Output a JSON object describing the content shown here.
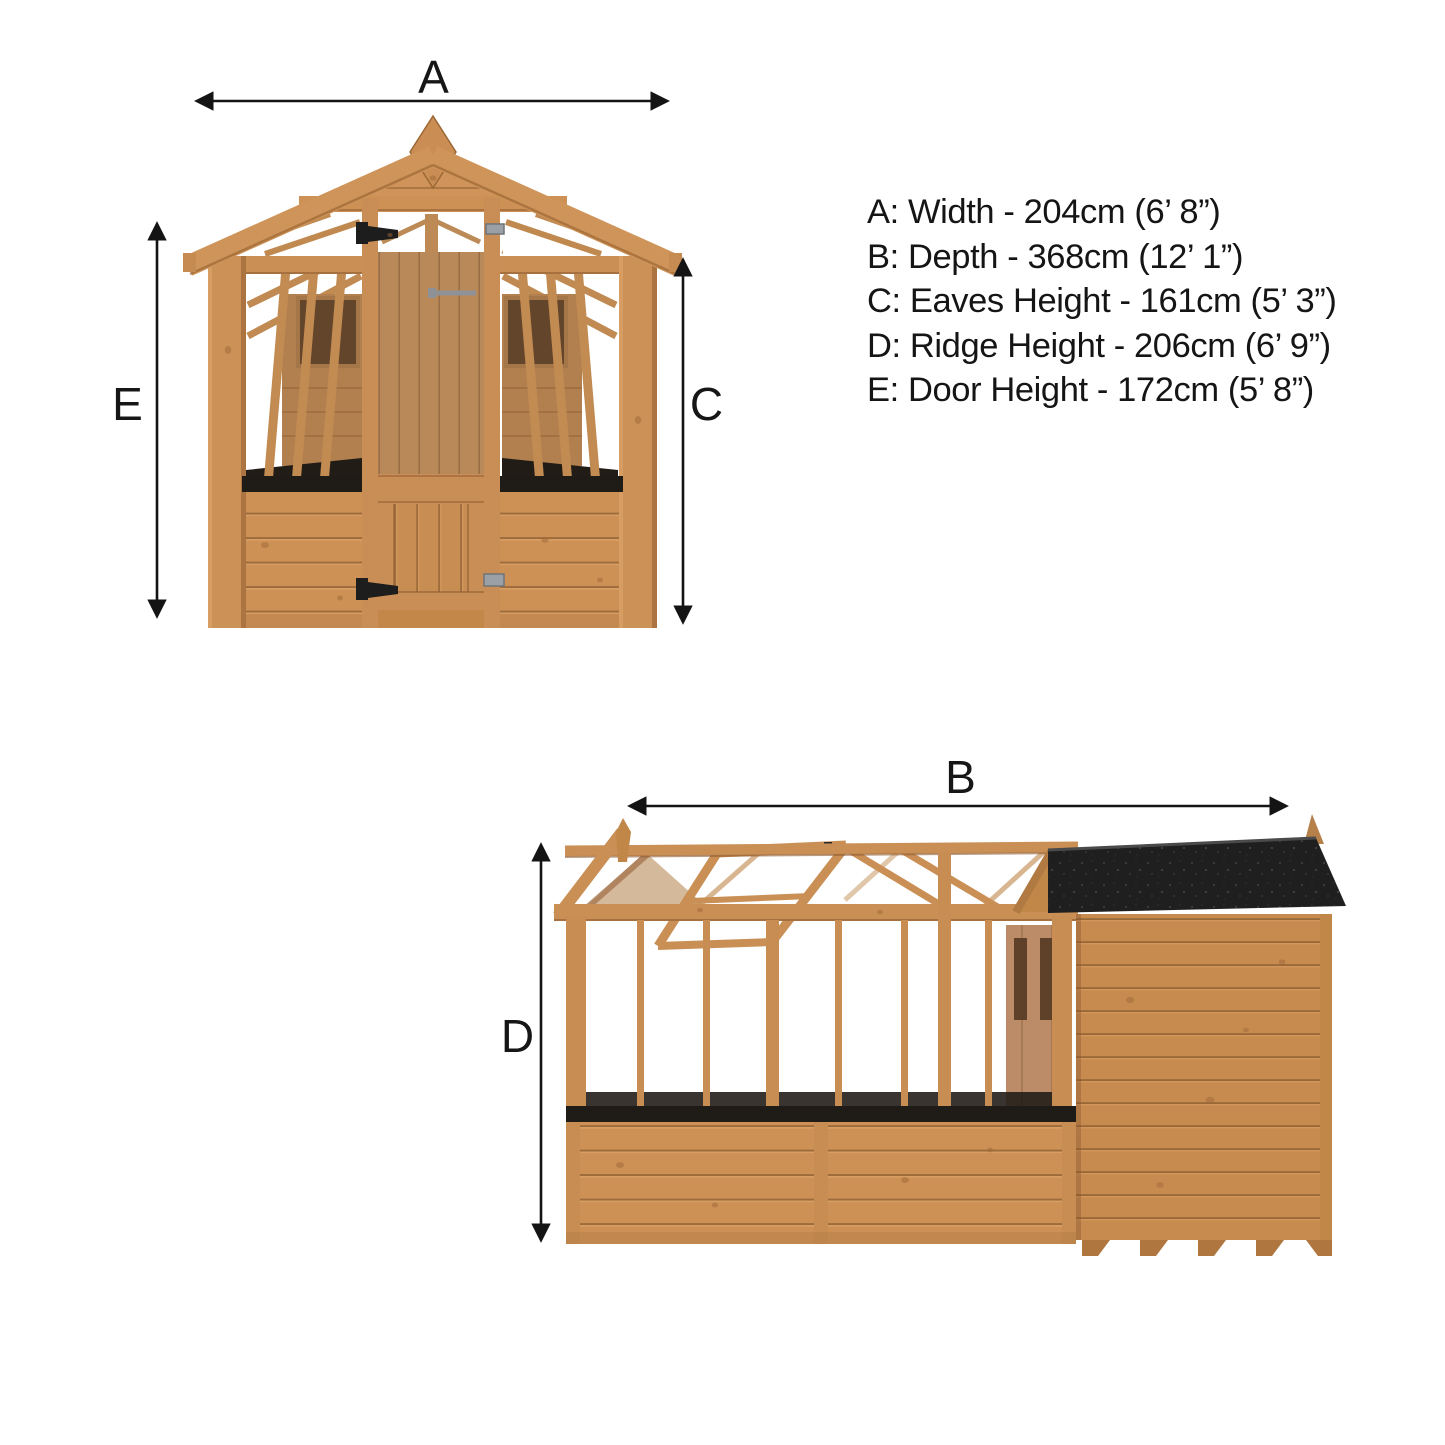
{
  "diagram": {
    "type": "product-dimension-diagram",
    "subject": "wooden greenhouse with attached shed",
    "views": [
      {
        "id": "front-elevation",
        "description": "front view with apex roof, central glazed door, side glazing panels"
      },
      {
        "id": "side-elevation",
        "description": "side view with greenhouse glazing, open roof vent and felt-roof shed"
      }
    ]
  },
  "dimension_labels": {
    "A": "A",
    "B": "B",
    "C": "C",
    "D": "D",
    "E": "E"
  },
  "specifications": [
    {
      "key": "A",
      "label": "Width",
      "metric": "204cm",
      "imperial": "6’ 8”",
      "text": "A: Width - 204cm (6’ 8”)"
    },
    {
      "key": "B",
      "label": "Depth",
      "metric": "368cm",
      "imperial": "12’ 1”",
      "text": "B: Depth - 368cm (12’ 1”)"
    },
    {
      "key": "C",
      "label": "Eaves Height",
      "metric": "161cm",
      "imperial": "5’ 3”",
      "text": "C: Eaves Height - 161cm (5’ 3”)"
    },
    {
      "key": "D",
      "label": "Ridge Height",
      "metric": "206cm",
      "imperial": "6’ 9”",
      "text": "D: Ridge Height - 206cm (6’ 9”)"
    },
    {
      "key": "E",
      "label": "Door Height",
      "metric": "172cm",
      "imperial": "5’ 8”",
      "text": "E: Door Height - 172cm (5’ 8”)"
    }
  ],
  "colors": {
    "background": "#ffffff",
    "wood": "#cd9156",
    "wood_light": "#dca368",
    "wood_dark": "#8f5c31",
    "interior_wood": "#b5825a",
    "window_dark": "#63452c",
    "roof_felt": "#1f1f1f",
    "sill_black": "#1f1b17",
    "metal_grey": "#9aa0a5",
    "arrow": "#141414"
  }
}
